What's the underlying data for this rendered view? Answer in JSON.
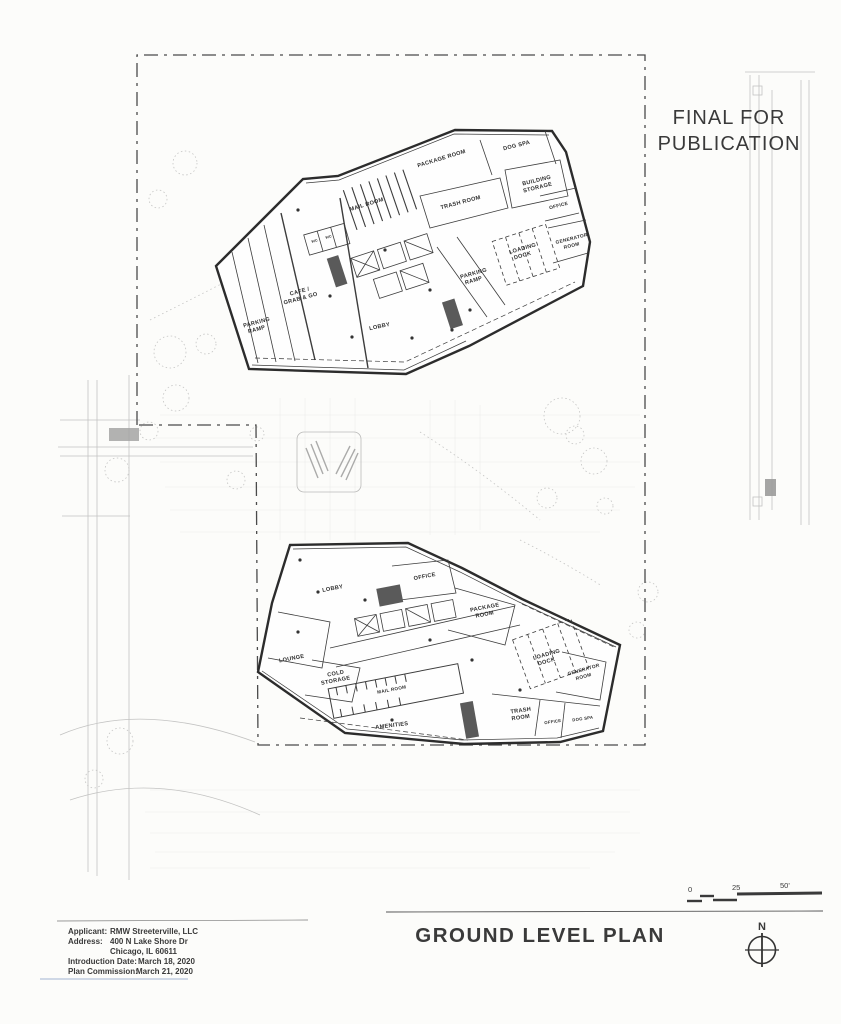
{
  "stamp": {
    "line1": "FINAL FOR",
    "line2": "PUBLICATION"
  },
  "title": "GROUND LEVEL PLAN",
  "project_info": {
    "applicant_label": "Applicant:",
    "applicant_value": "RMW Streeterville, LLC",
    "address_label": "Address:",
    "address_value": "400 N Lake Shore Dr",
    "address_value2": "Chicago, IL 60611",
    "introduction_label": "Introduction Date:",
    "introduction_value": "March 18, 2020",
    "commission_label": "Plan Commission:",
    "commission_value": "March 21, 2020"
  },
  "scale_bar": {
    "tick0": "0",
    "tick25": "25",
    "tick50": "50'"
  },
  "compass": {
    "label": "N"
  },
  "upper_building": {
    "rooms": [
      {
        "name": "package-room",
        "l1": "PACKAGE ROOM"
      },
      {
        "name": "dog-spa",
        "l1": "DOG SPA"
      },
      {
        "name": "mail-room",
        "l1": "MAIL ROOM"
      },
      {
        "name": "building-storage",
        "l1": "BUILDING",
        "l2": "STORAGE"
      },
      {
        "name": "trash-room",
        "l1": "TRASH ROOM"
      },
      {
        "name": "office",
        "l1": "OFFICE"
      },
      {
        "name": "generator-room",
        "l1": "GENERATOR",
        "l2": "ROOM"
      },
      {
        "name": "loading-dock",
        "l1": "LOADING",
        "l2": "DOCK"
      },
      {
        "name": "parking-ramp-east",
        "l1": "PARKING",
        "l2": "RAMP"
      },
      {
        "name": "cafe-grab-go",
        "l1": "CAFE /",
        "l2": "GRAB & GO"
      },
      {
        "name": "parking-ramp-west",
        "l1": "PARKING",
        "l2": "RAMP"
      },
      {
        "name": "lobby",
        "l1": "LOBBY"
      },
      {
        "name": "wc-a",
        "l1": "WC"
      },
      {
        "name": "wc-b",
        "l1": "WC"
      }
    ]
  },
  "lower_building": {
    "rooms": [
      {
        "name": "lobby",
        "l1": "LOBBY"
      },
      {
        "name": "office",
        "l1": "OFFICE"
      },
      {
        "name": "package-room",
        "l1": "PACKAGE",
        "l2": "ROOM"
      },
      {
        "name": "loading-dock",
        "l1": "LOADING",
        "l2": "DOCK"
      },
      {
        "name": "generator-room",
        "l1": "GENERATOR",
        "l2": "ROOM"
      },
      {
        "name": "lounge",
        "l1": "LOUNGE"
      },
      {
        "name": "cold-storage",
        "l1": "COLD",
        "l2": "STORAGE"
      },
      {
        "name": "mail-room",
        "l1": "MAIL ROOM"
      },
      {
        "name": "amenities",
        "l1": "AMENITIES"
      },
      {
        "name": "trash-room",
        "l1": "TRASH",
        "l2": "ROOM"
      },
      {
        "name": "office-2",
        "l1": "OFFICE"
      },
      {
        "name": "dog-spa",
        "l1": "DOG SPA"
      }
    ]
  }
}
